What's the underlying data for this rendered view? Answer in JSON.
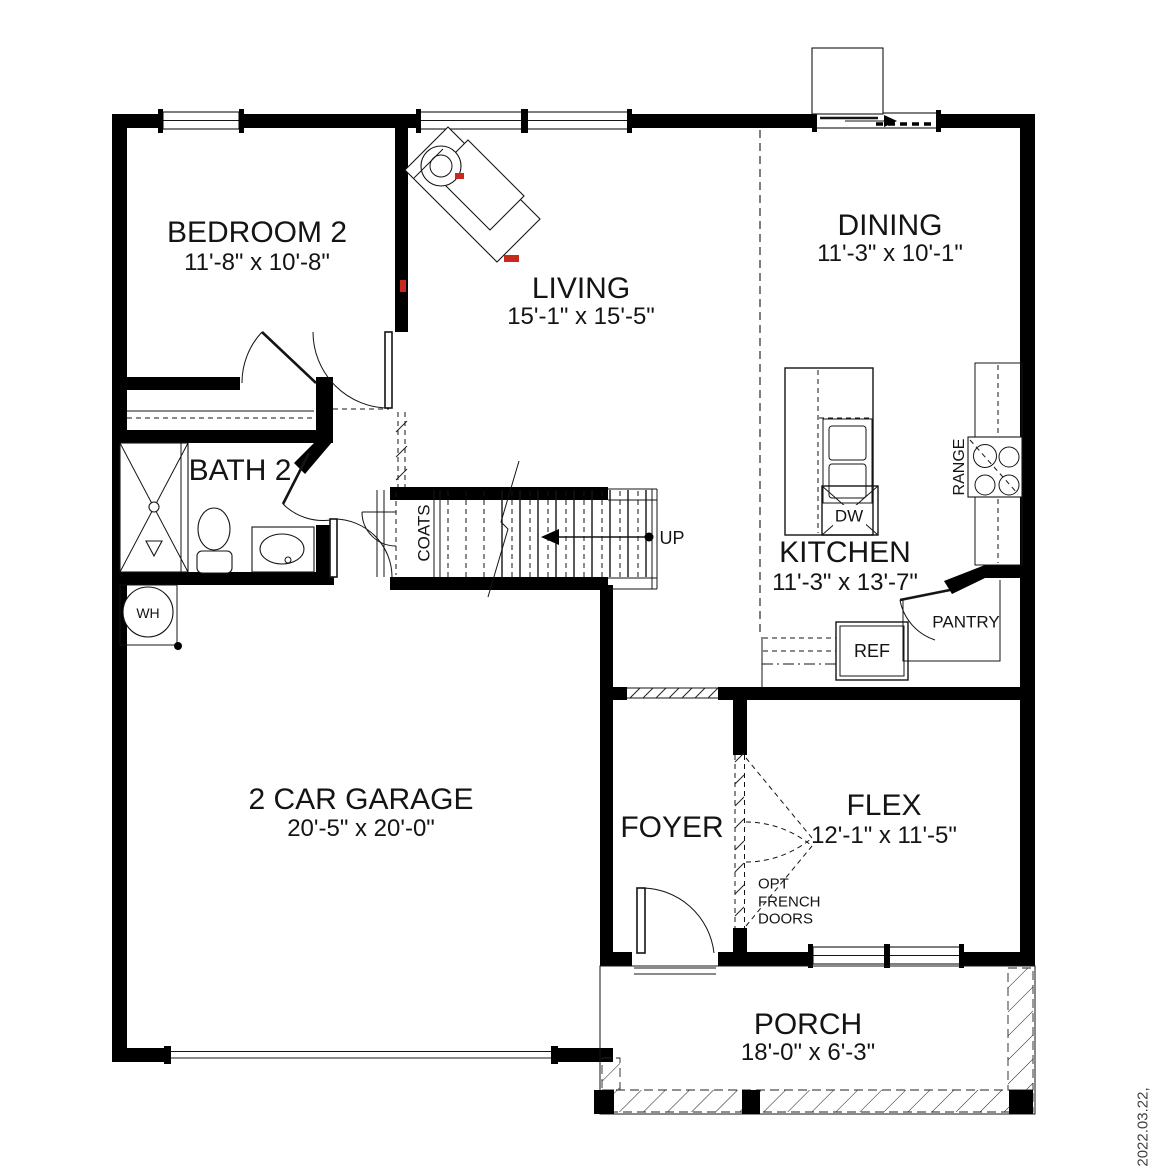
{
  "rooms": [
    {
      "name": "BEDROOM 2",
      "dims": "11'-8\" x 10'-8\""
    },
    {
      "name": "LIVING",
      "dims": "15'-1\" x 15'-5\""
    },
    {
      "name": "DINING",
      "dims": "11'-3\" x 10'-1\""
    },
    {
      "name": "BATH 2",
      "dims": ""
    },
    {
      "name": "KITCHEN",
      "dims": "11'-3\" x 13'-7\""
    },
    {
      "name": "2 CAR GARAGE",
      "dims": "20'-5\" x 20'-0\""
    },
    {
      "name": "FOYER",
      "dims": ""
    },
    {
      "name": "FLEX",
      "dims": "12'-1\" x 11'-5\""
    },
    {
      "name": "PORCH",
      "dims": "18'-0\" x 6'-3\""
    }
  ],
  "fixtures": {
    "water_heater": "WH",
    "coats_closet": "COATS",
    "stairs_direction": "UP",
    "dishwasher": "DW",
    "range": "RANGE",
    "refrigerator": "REF",
    "pantry": "PANTRY"
  },
  "annotations": {
    "french_doors_line1": "OPT",
    "french_doors_line2": "FRENCH",
    "french_doors_line3": "DOORS",
    "date_stamp": "2022.03.22,"
  },
  "colors": {
    "wall": "#000000",
    "line": "#141414",
    "background": "#ffffff",
    "artifact_red": "#c8281e",
    "date_gray": "#3f3f3f"
  }
}
